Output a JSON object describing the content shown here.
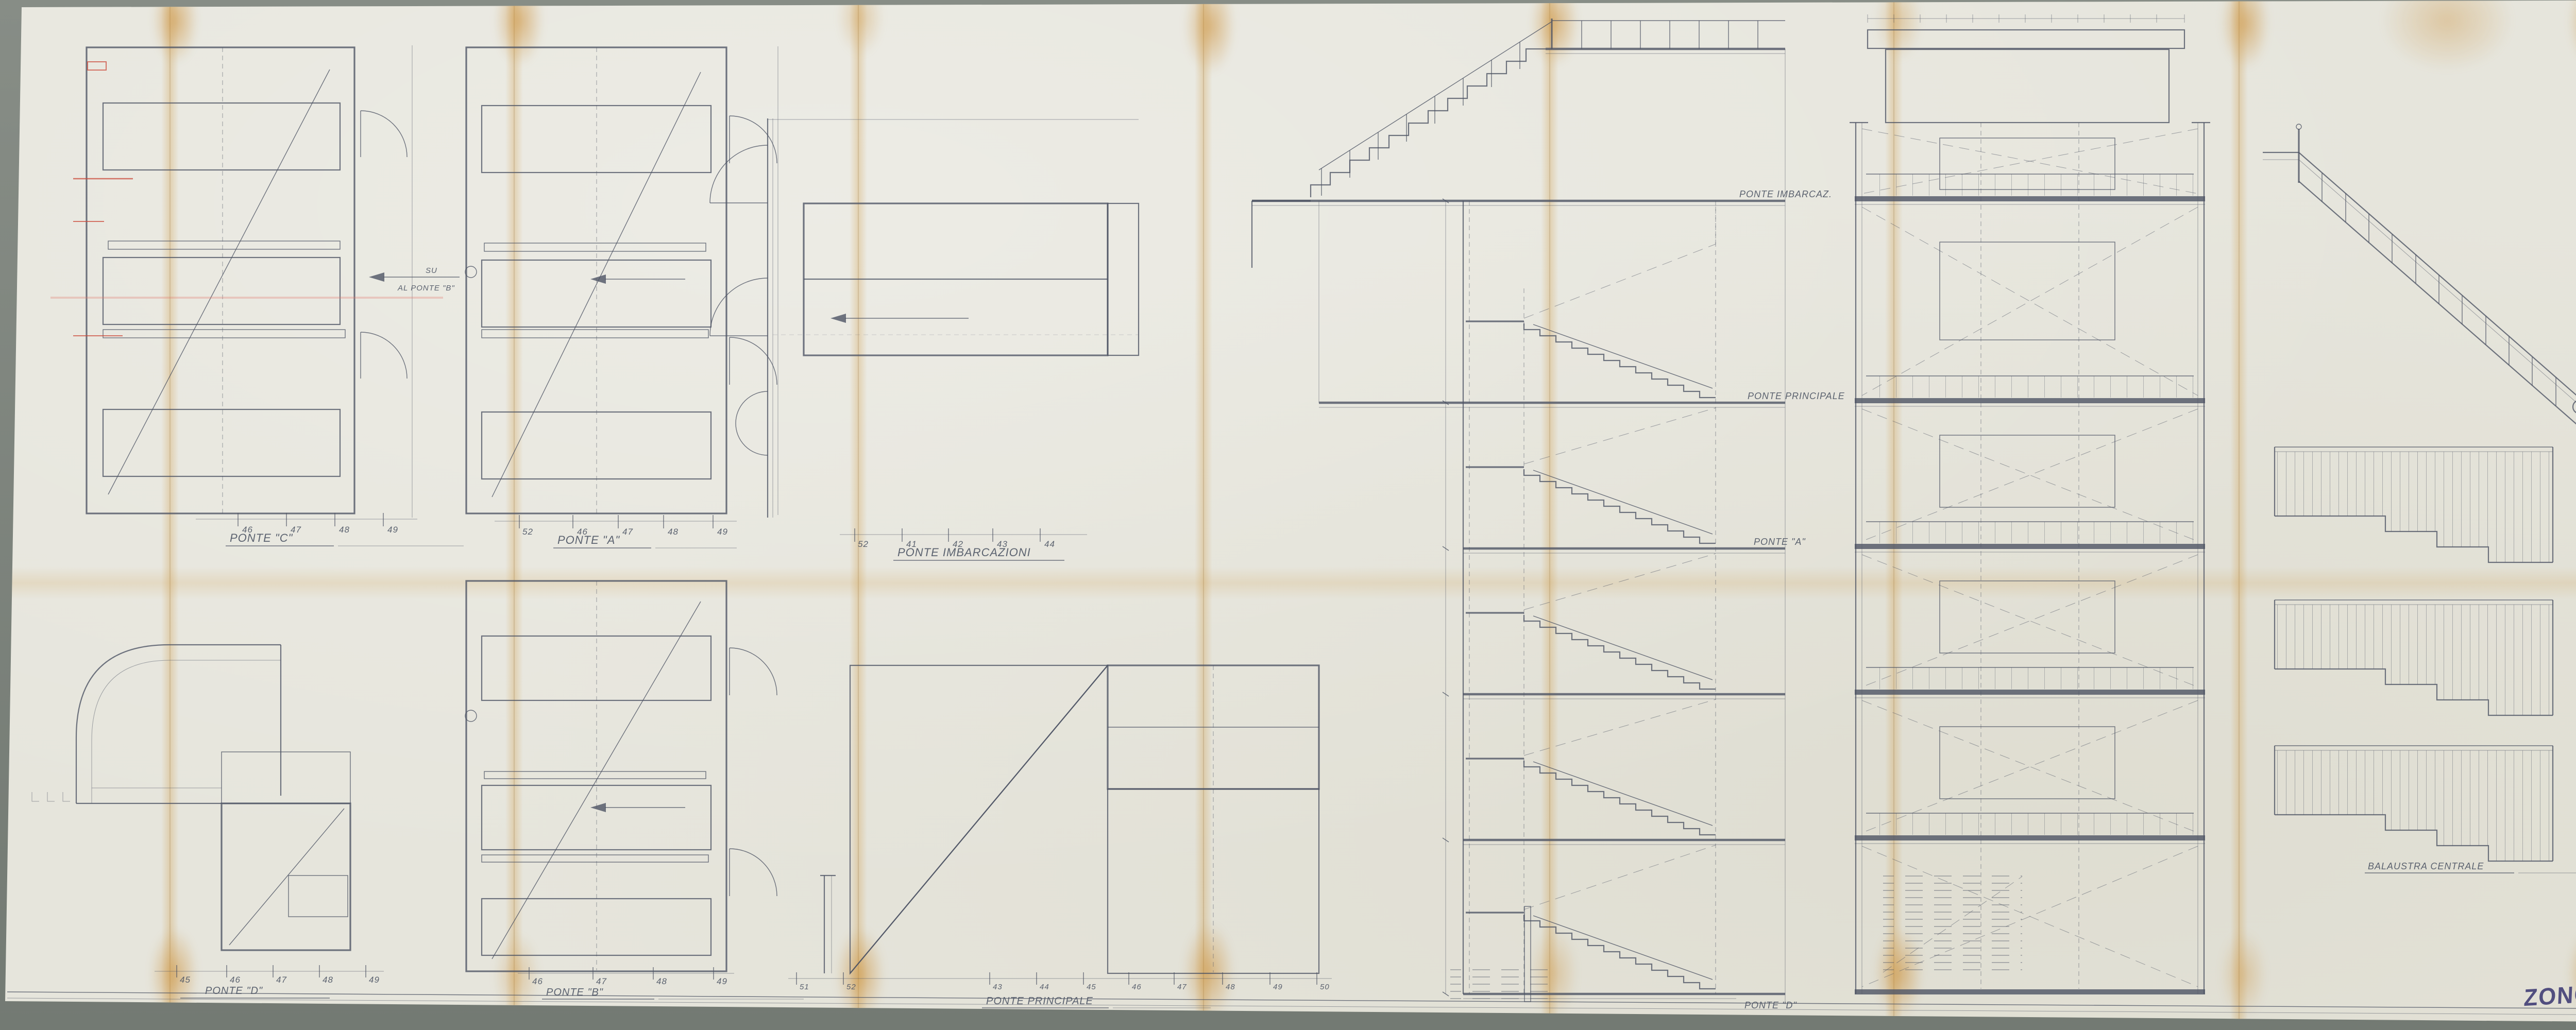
{
  "colors": {
    "paper": "#e6e5dc",
    "mat": "#7c827b",
    "ink": "#4d5464",
    "fold_stain": "#cd963c",
    "red_pencil": "#cb4a3a",
    "signature_ink": "#474379"
  },
  "sheet": {
    "signature": "ZONCADA",
    "stamp": {
      "dis": "DIS",
      "number": "76",
      "red_note": "2"
    },
    "title_block": {
      "line1": "STUDIO ARCHITETTURA",
      "line2": "PROF. NINO ZONCADA",
      "costr": "COSTR. 1876 - HOME LINES",
      "scalone": "SCALONE CL. TURISTICA",
      "ord": "ORD. 46-52",
      "piante": "PIANTE E VISTE",
      "data_label": "DATA",
      "data_value": "OTT/63",
      "scala_label": "SCALA",
      "scala_value": "1:25",
      "dis_label": "DIS. N°",
      "dis_value": "76"
    }
  },
  "plans": {
    "ponte_c": {
      "label": "PONTE \"C\"",
      "stations": [
        "46",
        "47",
        "48",
        "49"
      ],
      "note_su": "SU",
      "note_dest": "AL PONTE \"B\""
    },
    "ponte_a": {
      "label": "PONTE \"A\"",
      "stations": [
        "52",
        "46",
        "47",
        "48",
        "49"
      ]
    },
    "imbarcazioni": {
      "label": "PONTE IMBARCAZIONI",
      "stations": [
        "52",
        "41",
        "42",
        "43",
        "44"
      ]
    },
    "ponte_d": {
      "label": "PONTE \"D\"",
      "stations": [
        "45",
        "46",
        "47",
        "48",
        "49"
      ]
    },
    "ponte_b": {
      "label": "PONTE \"B\"",
      "stations": [
        "46",
        "47",
        "48",
        "49"
      ]
    },
    "principale": {
      "label": "PONTE PRINCIPALE",
      "stations": [
        "43",
        "44",
        "45",
        "46",
        "47",
        "48",
        "49",
        "50"
      ],
      "stations_left": [
        "51",
        "52"
      ]
    }
  },
  "section": {
    "deck_imbarcaz": "PONTE IMBARCAZ.",
    "deck_principale": "PONTE PRINCIPALE",
    "deck_a": "PONTE \"A\"",
    "deck_d": "PONTE \"D\""
  },
  "right_views": {
    "balaustra_label": "BALAUSTRA CENTRALE",
    "pencil_note": "7 G 14"
  }
}
